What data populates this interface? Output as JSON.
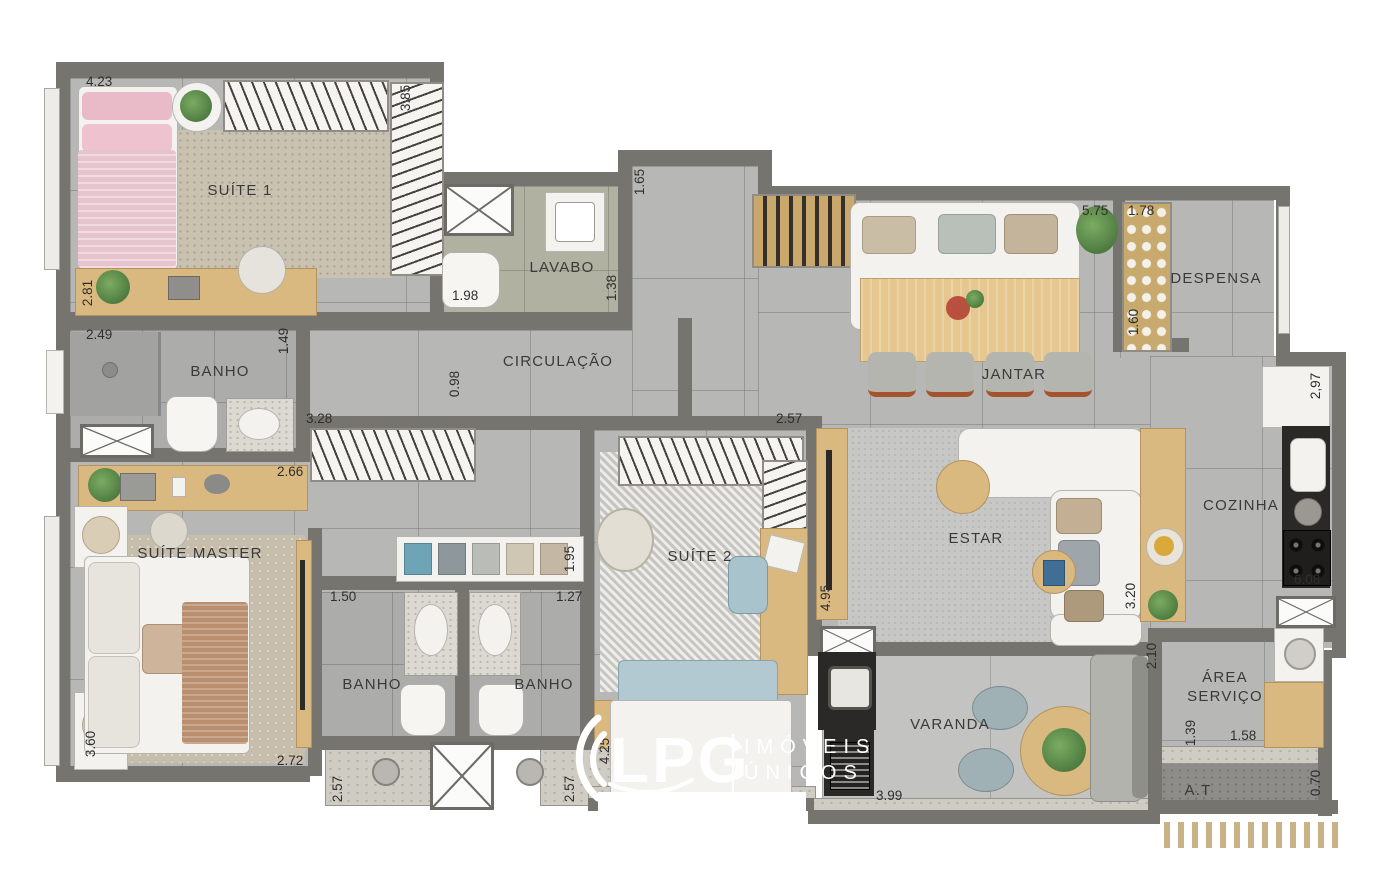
{
  "page": {
    "background": "#ffffff"
  },
  "logo": {
    "brand": "LPG",
    "tagline_line1": "IMÓVEIS",
    "tagline_line2": "ÚNICOS"
  },
  "palette": {
    "wall": "#75746e",
    "floor_tile": "#b7b8b6",
    "wood": "#d9b97f",
    "counter_dark": "#2b2927",
    "label_text": "#3a3a3a",
    "logo_white": "#ffffff"
  },
  "rooms": {
    "suite1": {
      "label": "SUÍTE 1"
    },
    "banho_suite1": {
      "label": "BANHO"
    },
    "lavabo": {
      "label": "LAVABO"
    },
    "circulacao": {
      "label": "CIRCULAÇÃO"
    },
    "jantar": {
      "label": "JANTAR"
    },
    "despensa": {
      "label": "DESPENSA"
    },
    "suite_master": {
      "label": "SUÍTE MASTER"
    },
    "banho_master": {
      "label": "BANHO"
    },
    "banho_suite2": {
      "label": "BANHO"
    },
    "suite2": {
      "label": "SUÍTE 2"
    },
    "estar": {
      "label": "ESTAR"
    },
    "cozinha": {
      "label": "COZINHA"
    },
    "varanda": {
      "label": "VARANDA"
    },
    "area_servico": {
      "label_line1": "ÁREA",
      "label_line2": "SERVIÇO"
    },
    "area_tecnica": {
      "label": "A.T"
    }
  },
  "dimensions": {
    "suite1_width": "4.23",
    "suite1_closet_depth": "3.85",
    "suite1_depth": "2.81",
    "banho_suite1_width": "2.49",
    "banho_suite1_depth": "1.49",
    "lavabo_width": "1.98",
    "lavabo_depth": "1.38",
    "entry_depth": "1.65",
    "circulacao_depth": "0.98",
    "jantar_width": "5.75",
    "despensa_width": "1.78",
    "despensa_depth": "1.60",
    "cozinha_window": "2,97",
    "master_closet_width": "3.28",
    "master_shelf_width": "2.66",
    "suite2_closet_width": "2.57",
    "corridor_shelf_depth": "1.95",
    "banho_master_width": "1.50",
    "banho_suite2_width": "1.27",
    "estar_depth": "4.95",
    "estar_width": "3.20",
    "cozinha_length": "6.08",
    "suite_master_depth": "3.60",
    "suite_master_width": "2.72",
    "banho_master_depth": "2.57",
    "banho_suite2_depth": "2.57",
    "suite2_depth": "4.25",
    "varanda_width": "3.99",
    "varanda_depth": "2.10",
    "servico_depth": "1.39",
    "servico_width": "1.58",
    "at_depth": "0.70"
  }
}
